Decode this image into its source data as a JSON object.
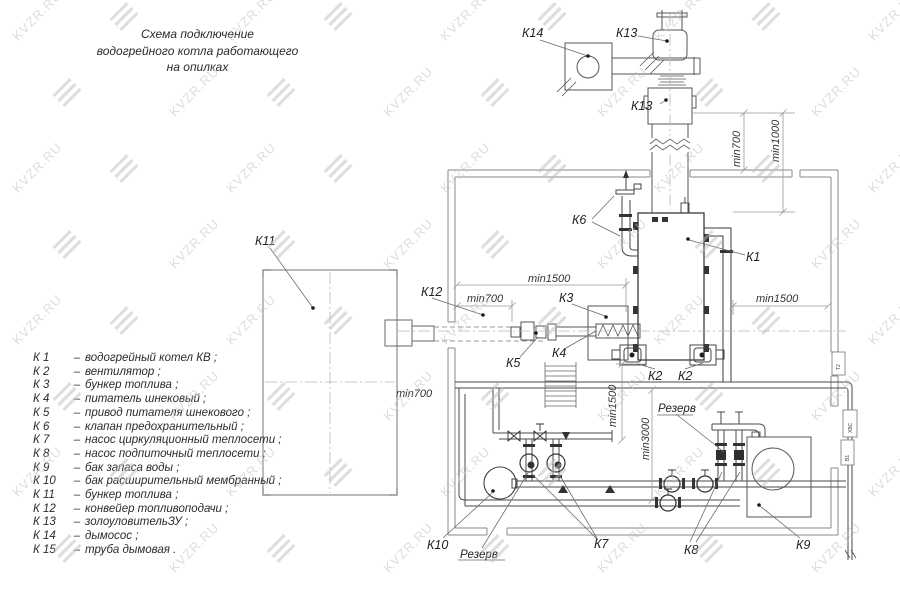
{
  "watermark": {
    "text": "KVZR.RU",
    "color": "#c3c3c3"
  },
  "title": {
    "lines": [
      "Схема подключение",
      "водогрейного котла работающего",
      "на опилках"
    ]
  },
  "legend": {
    "items": [
      {
        "k": "К 1",
        "name": "водогрейный котел КВ ;"
      },
      {
        "k": "К 2",
        "name": "вентилятор ;"
      },
      {
        "k": "К 3",
        "name": "бункер топлива ;"
      },
      {
        "k": "К 4",
        "name": "питатель шнековый ;"
      },
      {
        "k": "К 5",
        "name": "привод питателя шнекового ;"
      },
      {
        "k": "К 6",
        "name": "клапан предохранительный ;"
      },
      {
        "k": "К 7",
        "name": "насос циркуляционный теплосети ;"
      },
      {
        "k": "К 8",
        "name": "насос подпиточный теплосети ;"
      },
      {
        "k": "К 9",
        "name": "бак запаса воды ;"
      },
      {
        "k": "К 10",
        "name": "бак расширительный мембранный ;"
      },
      {
        "k": "К 11",
        "name": "бункер топлива ;"
      },
      {
        "k": "К 12",
        "name": "конвейер топливоподачи ;"
      },
      {
        "k": "К 13",
        "name": "золоуловительЗУ ;"
      },
      {
        "k": "К 14",
        "name": "дымосос ;"
      },
      {
        "k": "К 15",
        "name": "труба дымовая ."
      }
    ]
  },
  "diagram": {
    "labels": {
      "k1": "К1",
      "k2": "К2",
      "k3": "К3",
      "k4": "К4",
      "k5": "К5",
      "k6": "К6",
      "k7": "К7",
      "k8": "К8",
      "k9": "К9",
      "k10": "К10",
      "k11": "К11",
      "k12": "К12",
      "k13": "К13",
      "k14": "К14"
    },
    "dims": {
      "min700": "min700",
      "min1000": "min1000",
      "min1500": "min1500",
      "min3000": "min3000"
    },
    "reserve": "Резерв",
    "sleeves": [
      "Т2",
      "ХВС",
      "В1"
    ]
  }
}
